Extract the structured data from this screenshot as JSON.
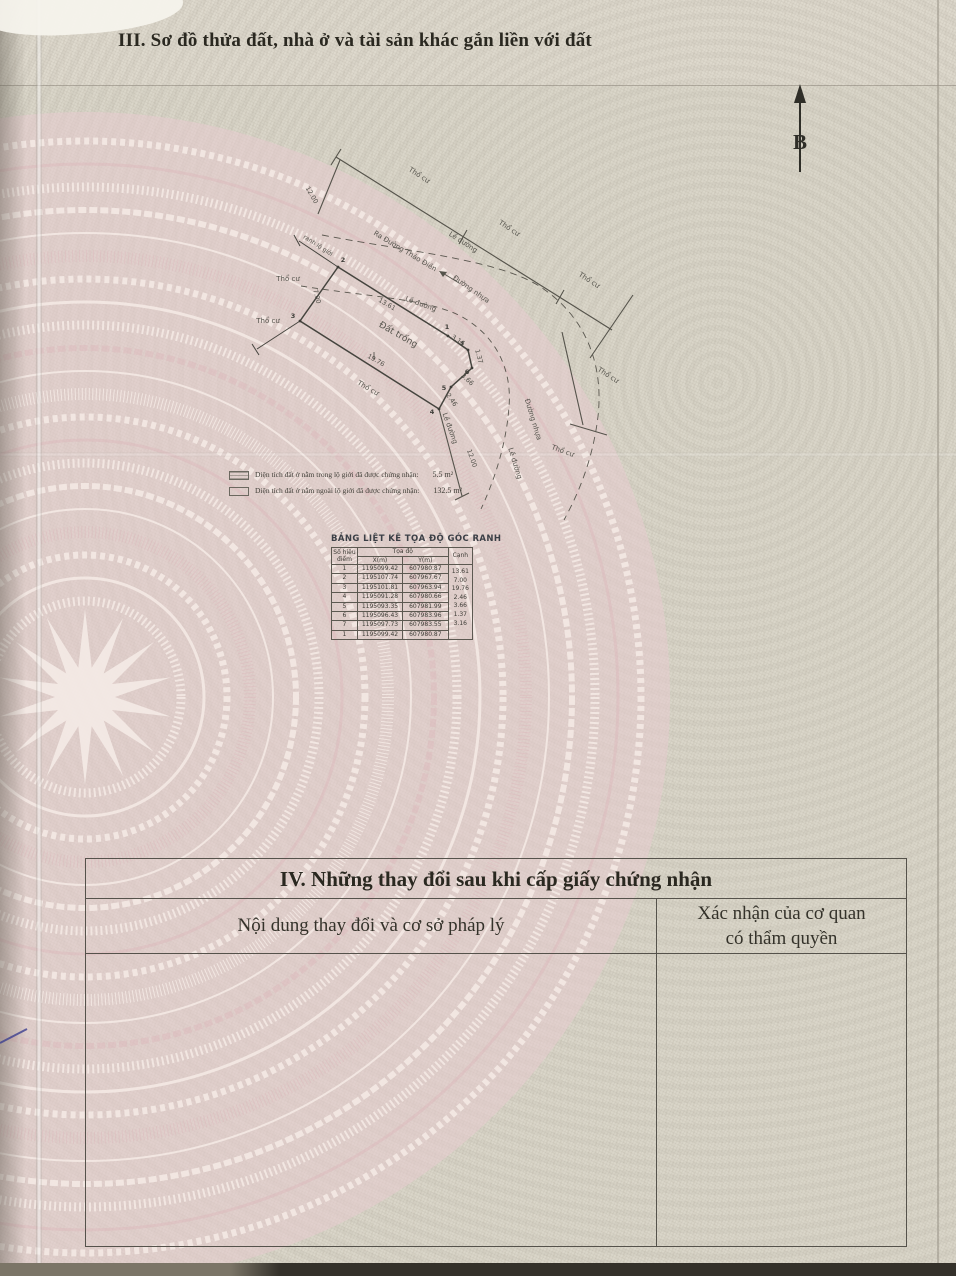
{
  "colors": {
    "paper": "#dcd8cc",
    "pink_ring": "#e4c2c6",
    "ink": "#2a2820",
    "diagram_ink": "#4c4a44",
    "table_border": "#55524b",
    "pen_mark": "#3d3f90"
  },
  "header": {
    "section3_title": "III. Sơ đồ thửa đất, nhà ở và tài sản khác gắn liền với đất"
  },
  "compass": {
    "label": "B"
  },
  "diagram": {
    "area_labels": [
      {
        "text": "Thổ cư",
        "x": 418,
        "y": 177,
        "r": 33
      },
      {
        "text": "Thổ cư",
        "x": 508,
        "y": 230,
        "r": 33
      },
      {
        "text": "Thổ cư",
        "x": 588,
        "y": 282,
        "r": 33
      },
      {
        "text": "Thổ cư",
        "x": 607,
        "y": 377,
        "r": 33
      },
      {
        "text": "Lề đường",
        "x": 462,
        "y": 244,
        "r": 33
      },
      {
        "text": "Ra Đường Thảo Điền",
        "x": 404,
        "y": 253,
        "r": 31
      },
      {
        "text": "Đường nhựa",
        "x": 470,
        "y": 291,
        "r": 35
      },
      {
        "text": "Lề đường",
        "x": 420,
        "y": 306,
        "r": 20
      },
      {
        "text": "Đất trống",
        "x": 397,
        "y": 337,
        "r": 30,
        "s": 9
      },
      {
        "text": "Thổ cư",
        "x": 367,
        "y": 390,
        "r": 30
      },
      {
        "text": "Thổ cư",
        "x": 288,
        "y": 281,
        "r": 0
      },
      {
        "text": "Thổ cư",
        "x": 268,
        "y": 323,
        "r": 0
      },
      {
        "text": "ranh lộ giới",
        "x": 317,
        "y": 247,
        "r": 33,
        "s": 6
      },
      {
        "text": "Lề đường",
        "x": 448,
        "y": 429,
        "r": 70
      },
      {
        "text": "Đường nhựa",
        "x": 531,
        "y": 420,
        "r": 73
      },
      {
        "text": "Lề đường",
        "x": 513,
        "y": 464,
        "r": 73
      },
      {
        "text": "Thổ cư",
        "x": 562,
        "y": 453,
        "r": 20
      }
    ],
    "dim_labels": [
      {
        "text": "12.00",
        "x": 310,
        "y": 196,
        "r": 60
      },
      {
        "text": "13.61",
        "x": 386,
        "y": 306,
        "r": 30
      },
      {
        "text": "7.00",
        "x": 315,
        "y": 297,
        "r": 75
      },
      {
        "text": "19.76",
        "x": 375,
        "y": 362,
        "r": 30
      },
      {
        "text": "2.46",
        "x": 450,
        "y": 401,
        "r": 55
      },
      {
        "text": "3.66",
        "x": 466,
        "y": 381,
        "r": 42
      },
      {
        "text": "1.37",
        "x": 477,
        "y": 357,
        "r": 75
      },
      {
        "text": "3.16",
        "x": 457,
        "y": 342,
        "r": 33
      },
      {
        "text": "12.00",
        "x": 470,
        "y": 459,
        "r": 70
      }
    ],
    "vertices": [
      {
        "n": "1",
        "px": 448,
        "py": 336,
        "lx": 447,
        "ly": 329
      },
      {
        "n": "2",
        "px": 338,
        "py": 267,
        "lx": 343,
        "ly": 262
      },
      {
        "n": "3",
        "px": 300,
        "py": 321,
        "lx": 293,
        "ly": 318
      },
      {
        "n": "4",
        "px": 439,
        "py": 409,
        "lx": 432,
        "ly": 414
      },
      {
        "n": "5",
        "px": 451,
        "py": 387,
        "lx": 444,
        "ly": 390
      },
      {
        "n": "6",
        "px": 472,
        "py": 368,
        "lx": 467,
        "ly": 374
      },
      {
        "n": "7",
        "px": 468,
        "py": 350,
        "lx": 462,
        "ly": 346
      }
    ]
  },
  "legend": {
    "rows": [
      {
        "label": "Diện tích đất ở nằm trong lộ giới đã được chứng nhận:",
        "value": "5.5 m²"
      },
      {
        "label": "Diện tích đất ở nằm ngoài lộ giới đã được chứng nhận:",
        "value": "132.5 m²"
      }
    ]
  },
  "coord_table": {
    "title": "BẢNG LIỆT KÊ TỌA ĐỘ GÓC RANH",
    "headers": {
      "point_l1": "Số hiệu",
      "point_l2": "điểm",
      "coords": "Tọa độ",
      "x": "X(m)",
      "y": "Y(m)",
      "edge": "Cạnh"
    },
    "rows": [
      {
        "p": "1",
        "x": "1195099.42",
        "y": "607980.87"
      },
      {
        "p": "2",
        "x": "1195107.74",
        "y": "607967.67"
      },
      {
        "p": "3",
        "x": "1195101.81",
        "y": "607963.94"
      },
      {
        "p": "4",
        "x": "1195091.28",
        "y": "607980.66"
      },
      {
        "p": "5",
        "x": "1195093.35",
        "y": "607981.99"
      },
      {
        "p": "6",
        "x": "1195096.43",
        "y": "607983.96"
      },
      {
        "p": "7",
        "x": "1195097.73",
        "y": "607983.55"
      },
      {
        "p": "1",
        "x": "1195099.42",
        "y": "607980.87"
      }
    ],
    "edges": [
      "13.61",
      "7.00",
      "19.76",
      "2.46",
      "3.66",
      "1.37",
      "3.16"
    ]
  },
  "section4": {
    "title": "IV. Những thay đổi sau khi cấp giấy chứng nhận",
    "col_left": "Nội dung thay đổi và cơ sở pháp lý",
    "col_right_l1": "Xác nhận của cơ quan",
    "col_right_l2": "có thẩm quyền"
  }
}
